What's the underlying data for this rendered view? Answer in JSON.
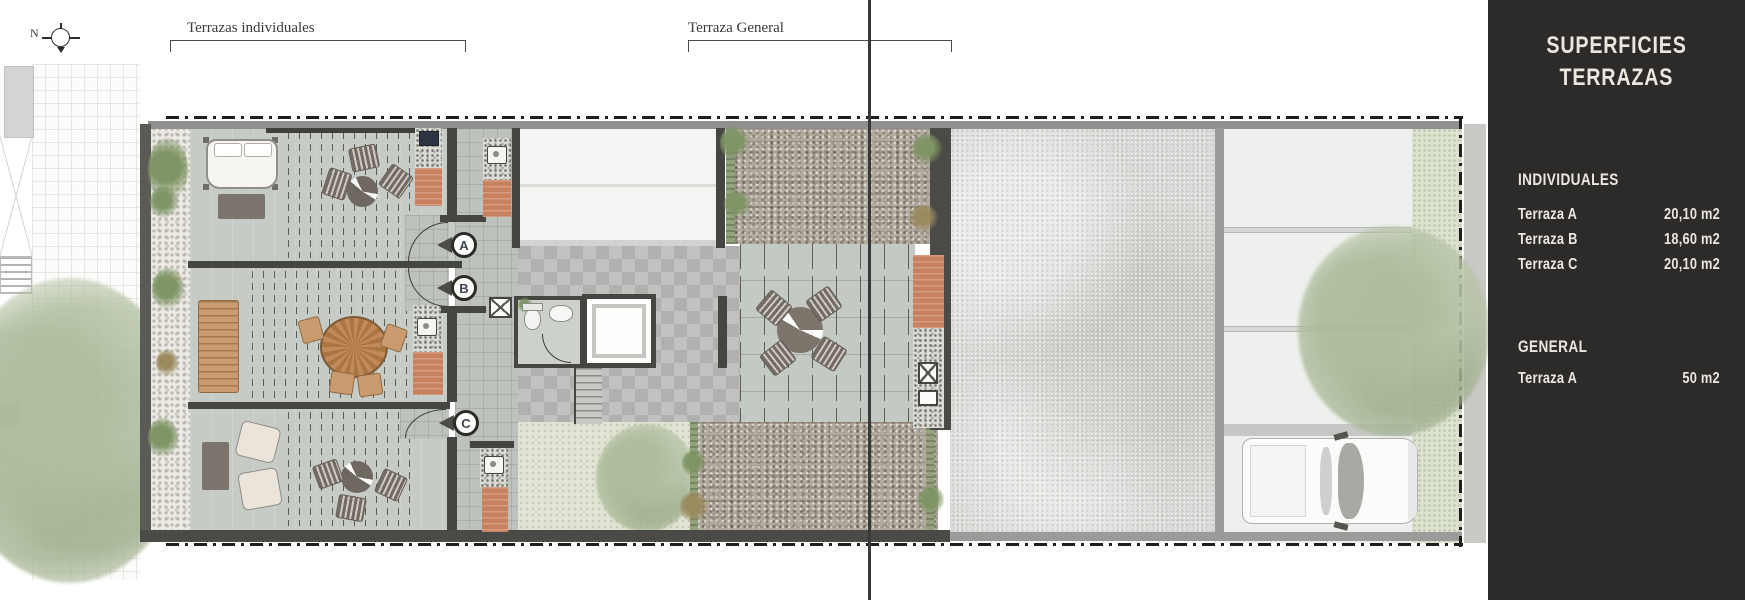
{
  "plan": {
    "compass_label": "N",
    "labels": {
      "individuales": "Terrazas individuales",
      "general": "Terraza General"
    },
    "unit_markers": [
      "A",
      "B",
      "C"
    ]
  },
  "sidebar": {
    "title_line1": "SUPERFICIES",
    "title_line2": "TERRAZAS",
    "sections": [
      {
        "heading": "INDIVIDUALES",
        "rows": [
          {
            "label": "Terraza A",
            "value": "20,10 m2"
          },
          {
            "label": "Terraza B",
            "value": "18,60 m2"
          },
          {
            "label": "Terraza C",
            "value": "20,10 m2"
          }
        ]
      },
      {
        "heading": "GENERAL",
        "rows": [
          {
            "label": "Terraza A",
            "value": "50 m2"
          }
        ]
      }
    ],
    "colors": {
      "panel_bg": "#2d2b29",
      "text": "#eae7df"
    }
  }
}
